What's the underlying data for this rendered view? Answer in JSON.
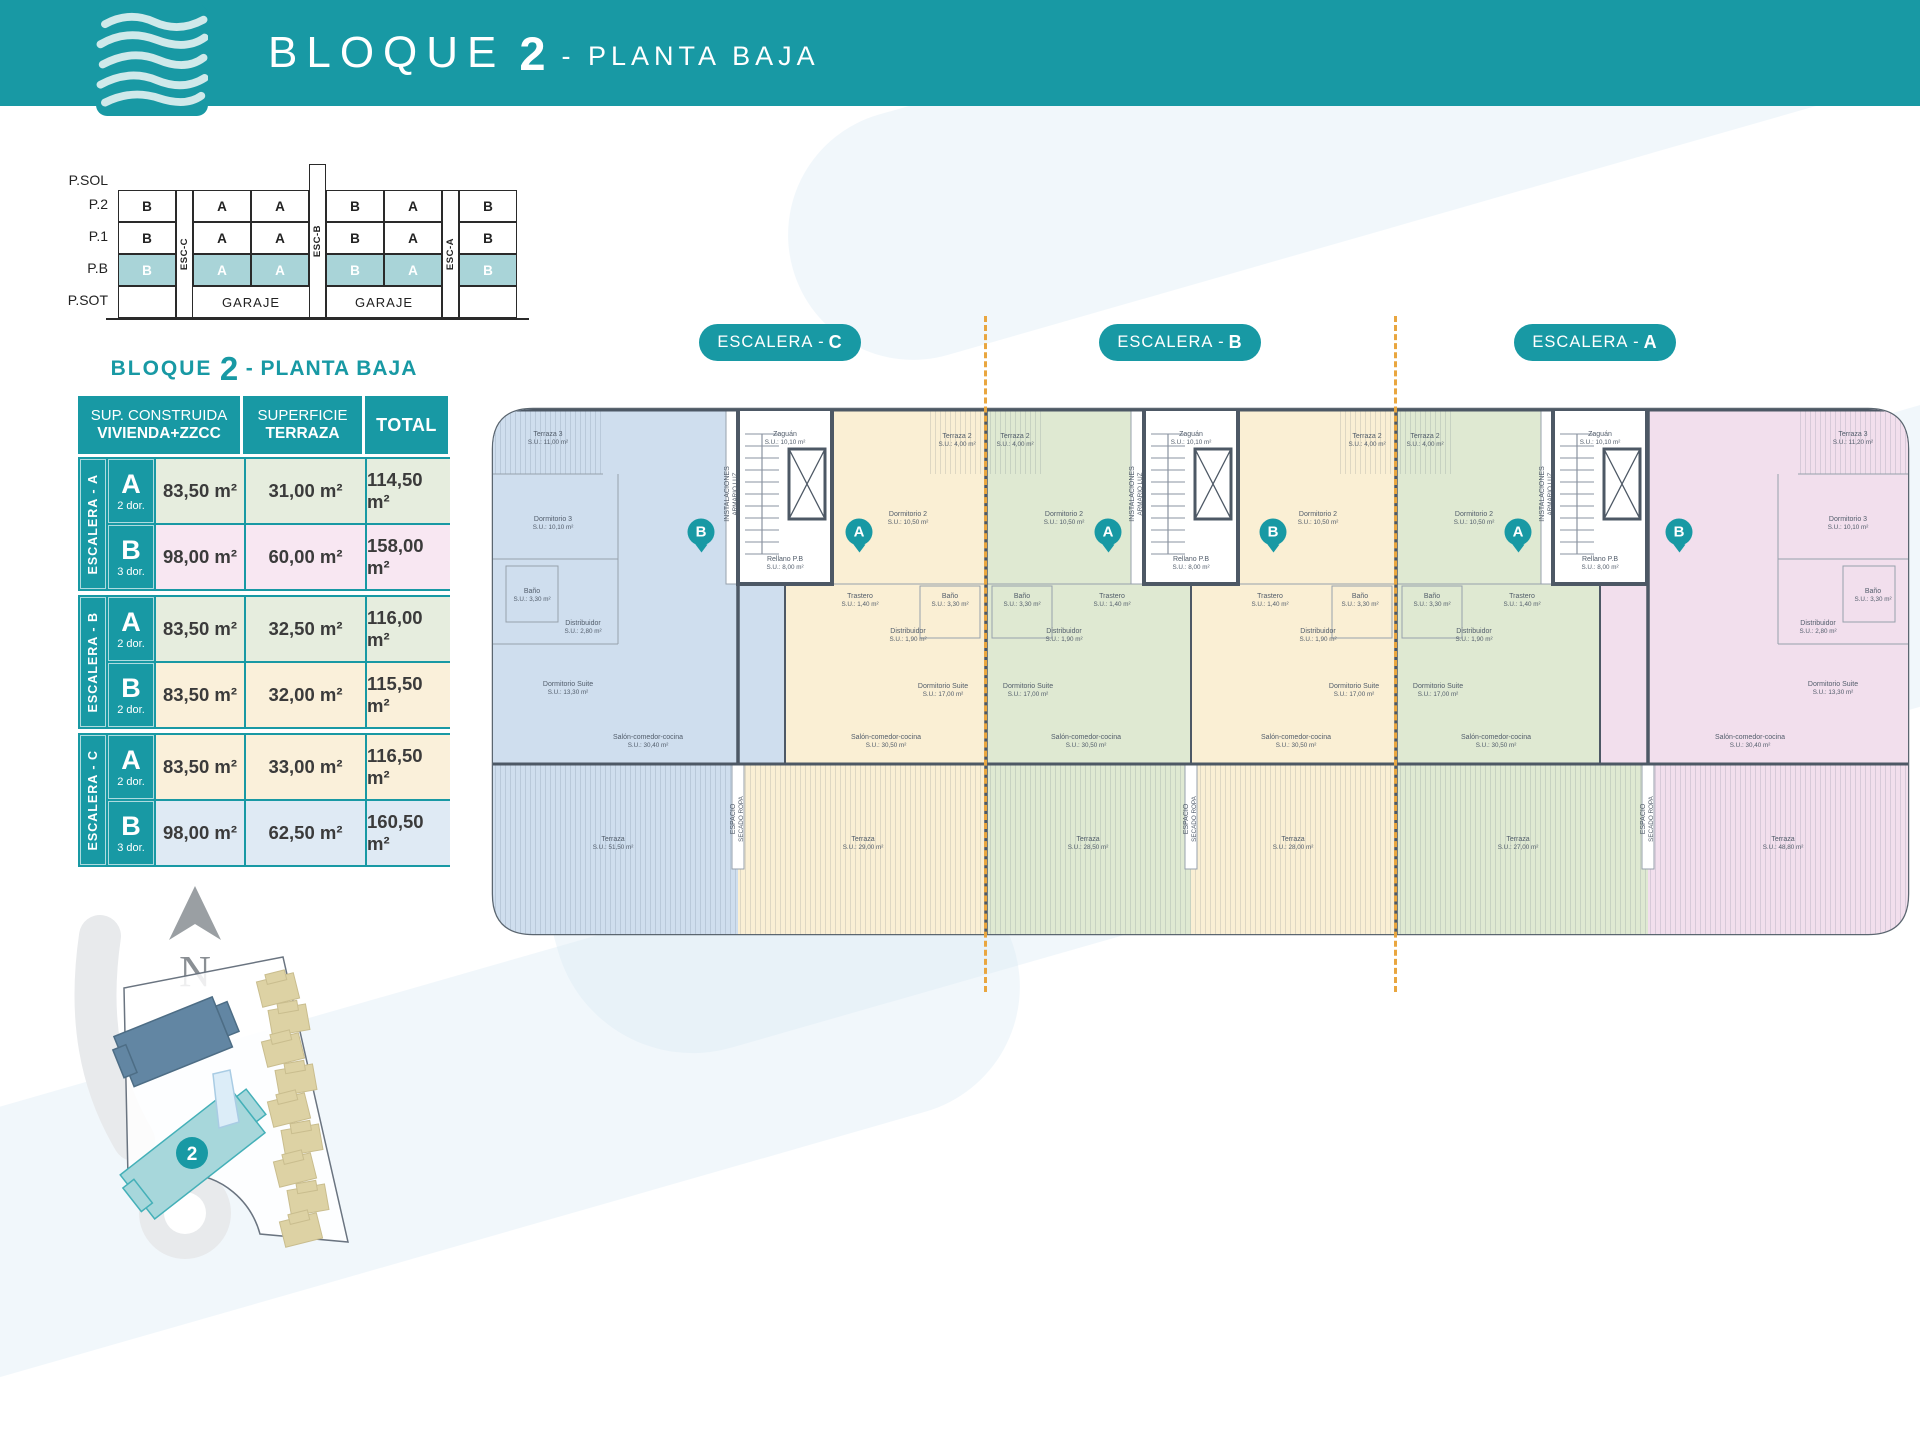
{
  "colors": {
    "teal": "#1899a4",
    "teal_light": "#a9d4d8",
    "orange": "#e9a63f",
    "wall": "#4d5865",
    "row_green": "#e6edde",
    "row_pink": "#f8e7f2",
    "row_cream": "#faf0da",
    "row_blue": "#dfeaf4",
    "unit_blue": "#cfdeee",
    "unit_cream": "#faefd4",
    "unit_green": "#dfe9d2",
    "unit_pink": "#f2dfed",
    "map_road": "#e8eaec",
    "map_block1": "#6286a3",
    "map_block2": "#a7d7db",
    "map_house": "#ddd2a4",
    "map_pool": "#dcedf8"
  },
  "header": {
    "title_main": "BLOQUE",
    "title_num": "2",
    "title_sub": "- PLANTA BAJA"
  },
  "stack": {
    "floors": [
      "P.SOL",
      "P.2",
      "P.1",
      "P.B",
      "P.SOT"
    ],
    "levels": [
      {
        "name": "P.2",
        "cells": [
          "B",
          "A",
          "A",
          "B",
          "A",
          "B"
        ]
      },
      {
        "name": "P.1",
        "cells": [
          "B",
          "A",
          "A",
          "B",
          "A",
          "B"
        ]
      },
      {
        "name": "P.B",
        "cells": [
          "B",
          "A",
          "A",
          "B",
          "A",
          "B"
        ]
      }
    ],
    "escaleras": [
      "ESC-C",
      "ESC-B",
      "ESC-A"
    ],
    "garaje": "GARAJE"
  },
  "table": {
    "title": {
      "pre": "BLOQUE",
      "num": "2",
      "post": "- PLANTA BAJA"
    },
    "header": {
      "c1a": "SUP. CONSTRUIDA",
      "c1b": "VIVIENDA+ZZCC",
      "c2a": "SUPERFICIE",
      "c2b": "TERRAZA",
      "c3": "TOTAL"
    },
    "groups": [
      {
        "label_pre": "ESCALERA - ",
        "label_letter": "A",
        "rows": [
          {
            "letter": "A",
            "dorm": "2 dor.",
            "built": "83,50 m²",
            "terrace": "31,00 m²",
            "total": "114,50 m²",
            "color": "row_green"
          },
          {
            "letter": "B",
            "dorm": "3 dor.",
            "built": "98,00 m²",
            "terrace": "60,00 m²",
            "total": "158,00 m²",
            "color": "row_pink"
          }
        ]
      },
      {
        "label_pre": "ESCALERA - ",
        "label_letter": "B",
        "rows": [
          {
            "letter": "A",
            "dorm": "2 dor.",
            "built": "83,50 m²",
            "terrace": "32,50 m²",
            "total": "116,00 m²",
            "color": "row_green"
          },
          {
            "letter": "B",
            "dorm": "2 dor.",
            "built": "83,50 m²",
            "terrace": "32,00 m²",
            "total": "115,50 m²",
            "color": "row_cream"
          }
        ]
      },
      {
        "label_pre": "ESCALERA - ",
        "label_letter": "C",
        "rows": [
          {
            "letter": "A",
            "dorm": "2 dor.",
            "built": "83,50 m²",
            "terrace": "33,00 m²",
            "total": "116,50 m²",
            "color": "row_cream"
          },
          {
            "letter": "B",
            "dorm": "3 dor.",
            "built": "98,00 m²",
            "terrace": "62,50 m²",
            "total": "160,50 m²",
            "color": "row_blue"
          }
        ]
      }
    ]
  },
  "plan": {
    "pills": [
      {
        "pre": "ESCALERA -",
        "letter": "C",
        "cx": 300
      },
      {
        "pre": "ESCALERA -",
        "letter": "B",
        "cx": 700
      },
      {
        "pre": "ESCALERA -",
        "letter": "A",
        "cx": 1115
      }
    ],
    "badges": [
      {
        "letter": "B",
        "x": 213,
        "y": 138
      },
      {
        "letter": "A",
        "x": 371,
        "y": 138
      },
      {
        "letter": "A",
        "x": 620,
        "y": 138
      },
      {
        "letter": "B",
        "x": 785,
        "y": 138
      },
      {
        "letter": "A",
        "x": 1030,
        "y": 138
      },
      {
        "letter": "B",
        "x": 1191,
        "y": 138
      }
    ],
    "labels": [
      {
        "t1": "Zaguán",
        "t2": "S.U.: 10,10 m²",
        "x": 297,
        "y": 45
      },
      {
        "t1": "Rellano P.B",
        "t2": "S.U.: 8,00 m²",
        "x": 297,
        "y": 170
      },
      {
        "t1": "Zaguán",
        "t2": "S.U.: 10,10 m²",
        "x": 703,
        "y": 45
      },
      {
        "t1": "Rellano P.B",
        "t2": "S.U.: 8,00 m²",
        "x": 703,
        "y": 170
      },
      {
        "t1": "Zaguán",
        "t2": "S.U.: 10,10 m²",
        "x": 1112,
        "y": 45
      },
      {
        "t1": "Rellano P.B",
        "t2": "S.U.: 8,00 m²",
        "x": 1112,
        "y": 170
      },
      {
        "t1": "INSTALACIONES",
        "t2": "ARMARIO LUZ",
        "x": 244,
        "y": 100,
        "v": 1
      },
      {
        "t1": "INSTALACIONES",
        "t2": "ARMARIO LUZ",
        "x": 649,
        "y": 100,
        "v": 1
      },
      {
        "t1": "INSTALACIONES",
        "t2": "ARMARIO LUZ",
        "x": 1059,
        "y": 100,
        "v": 1
      },
      {
        "t1": "Terraza 3",
        "t2": "S.U.: 11,00 m²",
        "x": 60,
        "y": 45
      },
      {
        "t1": "Dormitorio 3",
        "t2": "S.U.: 10,10 m²",
        "x": 65,
        "y": 130
      },
      {
        "t1": "Baño",
        "t2": "S.U.: 3,30 m²",
        "x": 44,
        "y": 202
      },
      {
        "t1": "Distribuidor",
        "t2": "S.U.: 2,80 m²",
        "x": 95,
        "y": 234
      },
      {
        "t1": "Dormitorio Suite",
        "t2": "S.U.: 13,30 m²",
        "x": 80,
        "y": 295
      },
      {
        "t1": "Salón-comedor-cocina",
        "t2": "S.U.: 30,40 m²",
        "x": 160,
        "y": 348
      },
      {
        "t1": "Terraza",
        "t2": "S.U.: 51,50 m²",
        "x": 125,
        "y": 450
      },
      {
        "t1": "Dormitorio 2",
        "t2": "S.U.: 10,50 m²",
        "x": 420,
        "y": 125
      },
      {
        "t1": "Trastero",
        "t2": "S.U.: 1,40 m²",
        "x": 372,
        "y": 207
      },
      {
        "t1": "Baño",
        "t2": "S.U.: 3,30 m²",
        "x": 462,
        "y": 207
      },
      {
        "t1": "Distribuidor",
        "t2": "S.U.: 1,90 m²",
        "x": 420,
        "y": 242
      },
      {
        "t1": "Dormitorio Suite",
        "t2": "S.U.: 17,00 m²",
        "x": 455,
        "y": 297
      },
      {
        "t1": "Salón-comedor-cocina",
        "t2": "S.U.: 30,50 m²",
        "x": 398,
        "y": 348
      },
      {
        "t1": "Terraza",
        "t2": "S.U.: 29,00 m²",
        "x": 375,
        "y": 450
      },
      {
        "t1": "Dormitorio 2",
        "t2": "S.U.: 10,50 m²",
        "x": 576,
        "y": 125
      },
      {
        "t1": "Trastero",
        "t2": "S.U.: 1,40 m²",
        "x": 624,
        "y": 207
      },
      {
        "t1": "Baño",
        "t2": "S.U.: 3,30 m²",
        "x": 534,
        "y": 207
      },
      {
        "t1": "Distribuidor",
        "t2": "S.U.: 1,90 m²",
        "x": 576,
        "y": 242
      },
      {
        "t1": "Dormitorio Suite",
        "t2": "S.U.: 17,00 m²",
        "x": 540,
        "y": 297
      },
      {
        "t1": "Salón-comedor-cocina",
        "t2": "S.U.: 30,50 m²",
        "x": 598,
        "y": 348
      },
      {
        "t1": "Terraza",
        "t2": "S.U.: 28,50 m²",
        "x": 600,
        "y": 450
      },
      {
        "t1": "Dormitorio 2",
        "t2": "S.U.: 10,50 m²",
        "x": 830,
        "y": 125
      },
      {
        "t1": "Trastero",
        "t2": "S.U.: 1,40 m²",
        "x": 782,
        "y": 207
      },
      {
        "t1": "Baño",
        "t2": "S.U.: 3,30 m²",
        "x": 872,
        "y": 207
      },
      {
        "t1": "Distribuidor",
        "t2": "S.U.: 1,90 m²",
        "x": 830,
        "y": 242
      },
      {
        "t1": "Dormitorio Suite",
        "t2": "S.U.: 17,00 m²",
        "x": 866,
        "y": 297
      },
      {
        "t1": "Salón-comedor-cocina",
        "t2": "S.U.: 30,50 m²",
        "x": 808,
        "y": 348
      },
      {
        "t1": "Terraza",
        "t2": "S.U.: 28,00 m²",
        "x": 805,
        "y": 450
      },
      {
        "t1": "Dormitorio 2",
        "t2": "S.U.: 10,50 m²",
        "x": 986,
        "y": 125
      },
      {
        "t1": "Trastero",
        "t2": "S.U.: 1,40 m²",
        "x": 1034,
        "y": 207
      },
      {
        "t1": "Baño",
        "t2": "S.U.: 3,30 m²",
        "x": 944,
        "y": 207
      },
      {
        "t1": "Distribuidor",
        "t2": "S.U.: 1,90 m²",
        "x": 986,
        "y": 242
      },
      {
        "t1": "Dormitorio Suite",
        "t2": "S.U.: 17,00 m²",
        "x": 950,
        "y": 297
      },
      {
        "t1": "Salón-comedor-cocina",
        "t2": "S.U.: 30,50 m²",
        "x": 1008,
        "y": 348
      },
      {
        "t1": "Terraza",
        "t2": "S.U.: 27,00 m²",
        "x": 1030,
        "y": 450
      },
      {
        "t1": "Terraza 3",
        "t2": "S.U.: 11,20 m²",
        "x": 1365,
        "y": 45
      },
      {
        "t1": "Dormitorio 3",
        "t2": "S.U.: 10,10 m²",
        "x": 1360,
        "y": 130
      },
      {
        "t1": "Baño",
        "t2": "S.U.: 3,30 m²",
        "x": 1385,
        "y": 202
      },
      {
        "t1": "Distribuidor",
        "t2": "S.U.: 2,80 m²",
        "x": 1330,
        "y": 234
      },
      {
        "t1": "Dormitorio Suite",
        "t2": "S.U.: 13,30 m²",
        "x": 1345,
        "y": 295
      },
      {
        "t1": "Salón-comedor-cocina",
        "t2": "S.U.: 30,40 m²",
        "x": 1262,
        "y": 348
      },
      {
        "t1": "Terraza",
        "t2": "S.U.: 48,80 m²",
        "x": 1295,
        "y": 450
      },
      {
        "t1": "Terraza 2",
        "t2": "S.U.: 4,00 m²",
        "x": 469,
        "y": 47
      },
      {
        "t1": "Terraza 2",
        "t2": "S.U.: 4,00 m²",
        "x": 527,
        "y": 47
      },
      {
        "t1": "Terraza 2",
        "t2": "S.U.: 4,00 m²",
        "x": 879,
        "y": 47
      },
      {
        "t1": "Terraza 2",
        "t2": "S.U.: 4,00 m²",
        "x": 937,
        "y": 47
      },
      {
        "t1": "ESPACIO",
        "t2": "SECADO ROPA",
        "x": 250,
        "y": 425,
        "v": 1
      },
      {
        "t1": "ESPACIO",
        "t2": "SECADO ROPA",
        "x": 703,
        "y": 425,
        "v": 1
      },
      {
        "t1": "ESPACIO",
        "t2": "SECADO ROPA",
        "x": 1160,
        "y": 425,
        "v": 1
      }
    ]
  },
  "sitemap": {
    "north": "N",
    "block_badge": "2"
  }
}
